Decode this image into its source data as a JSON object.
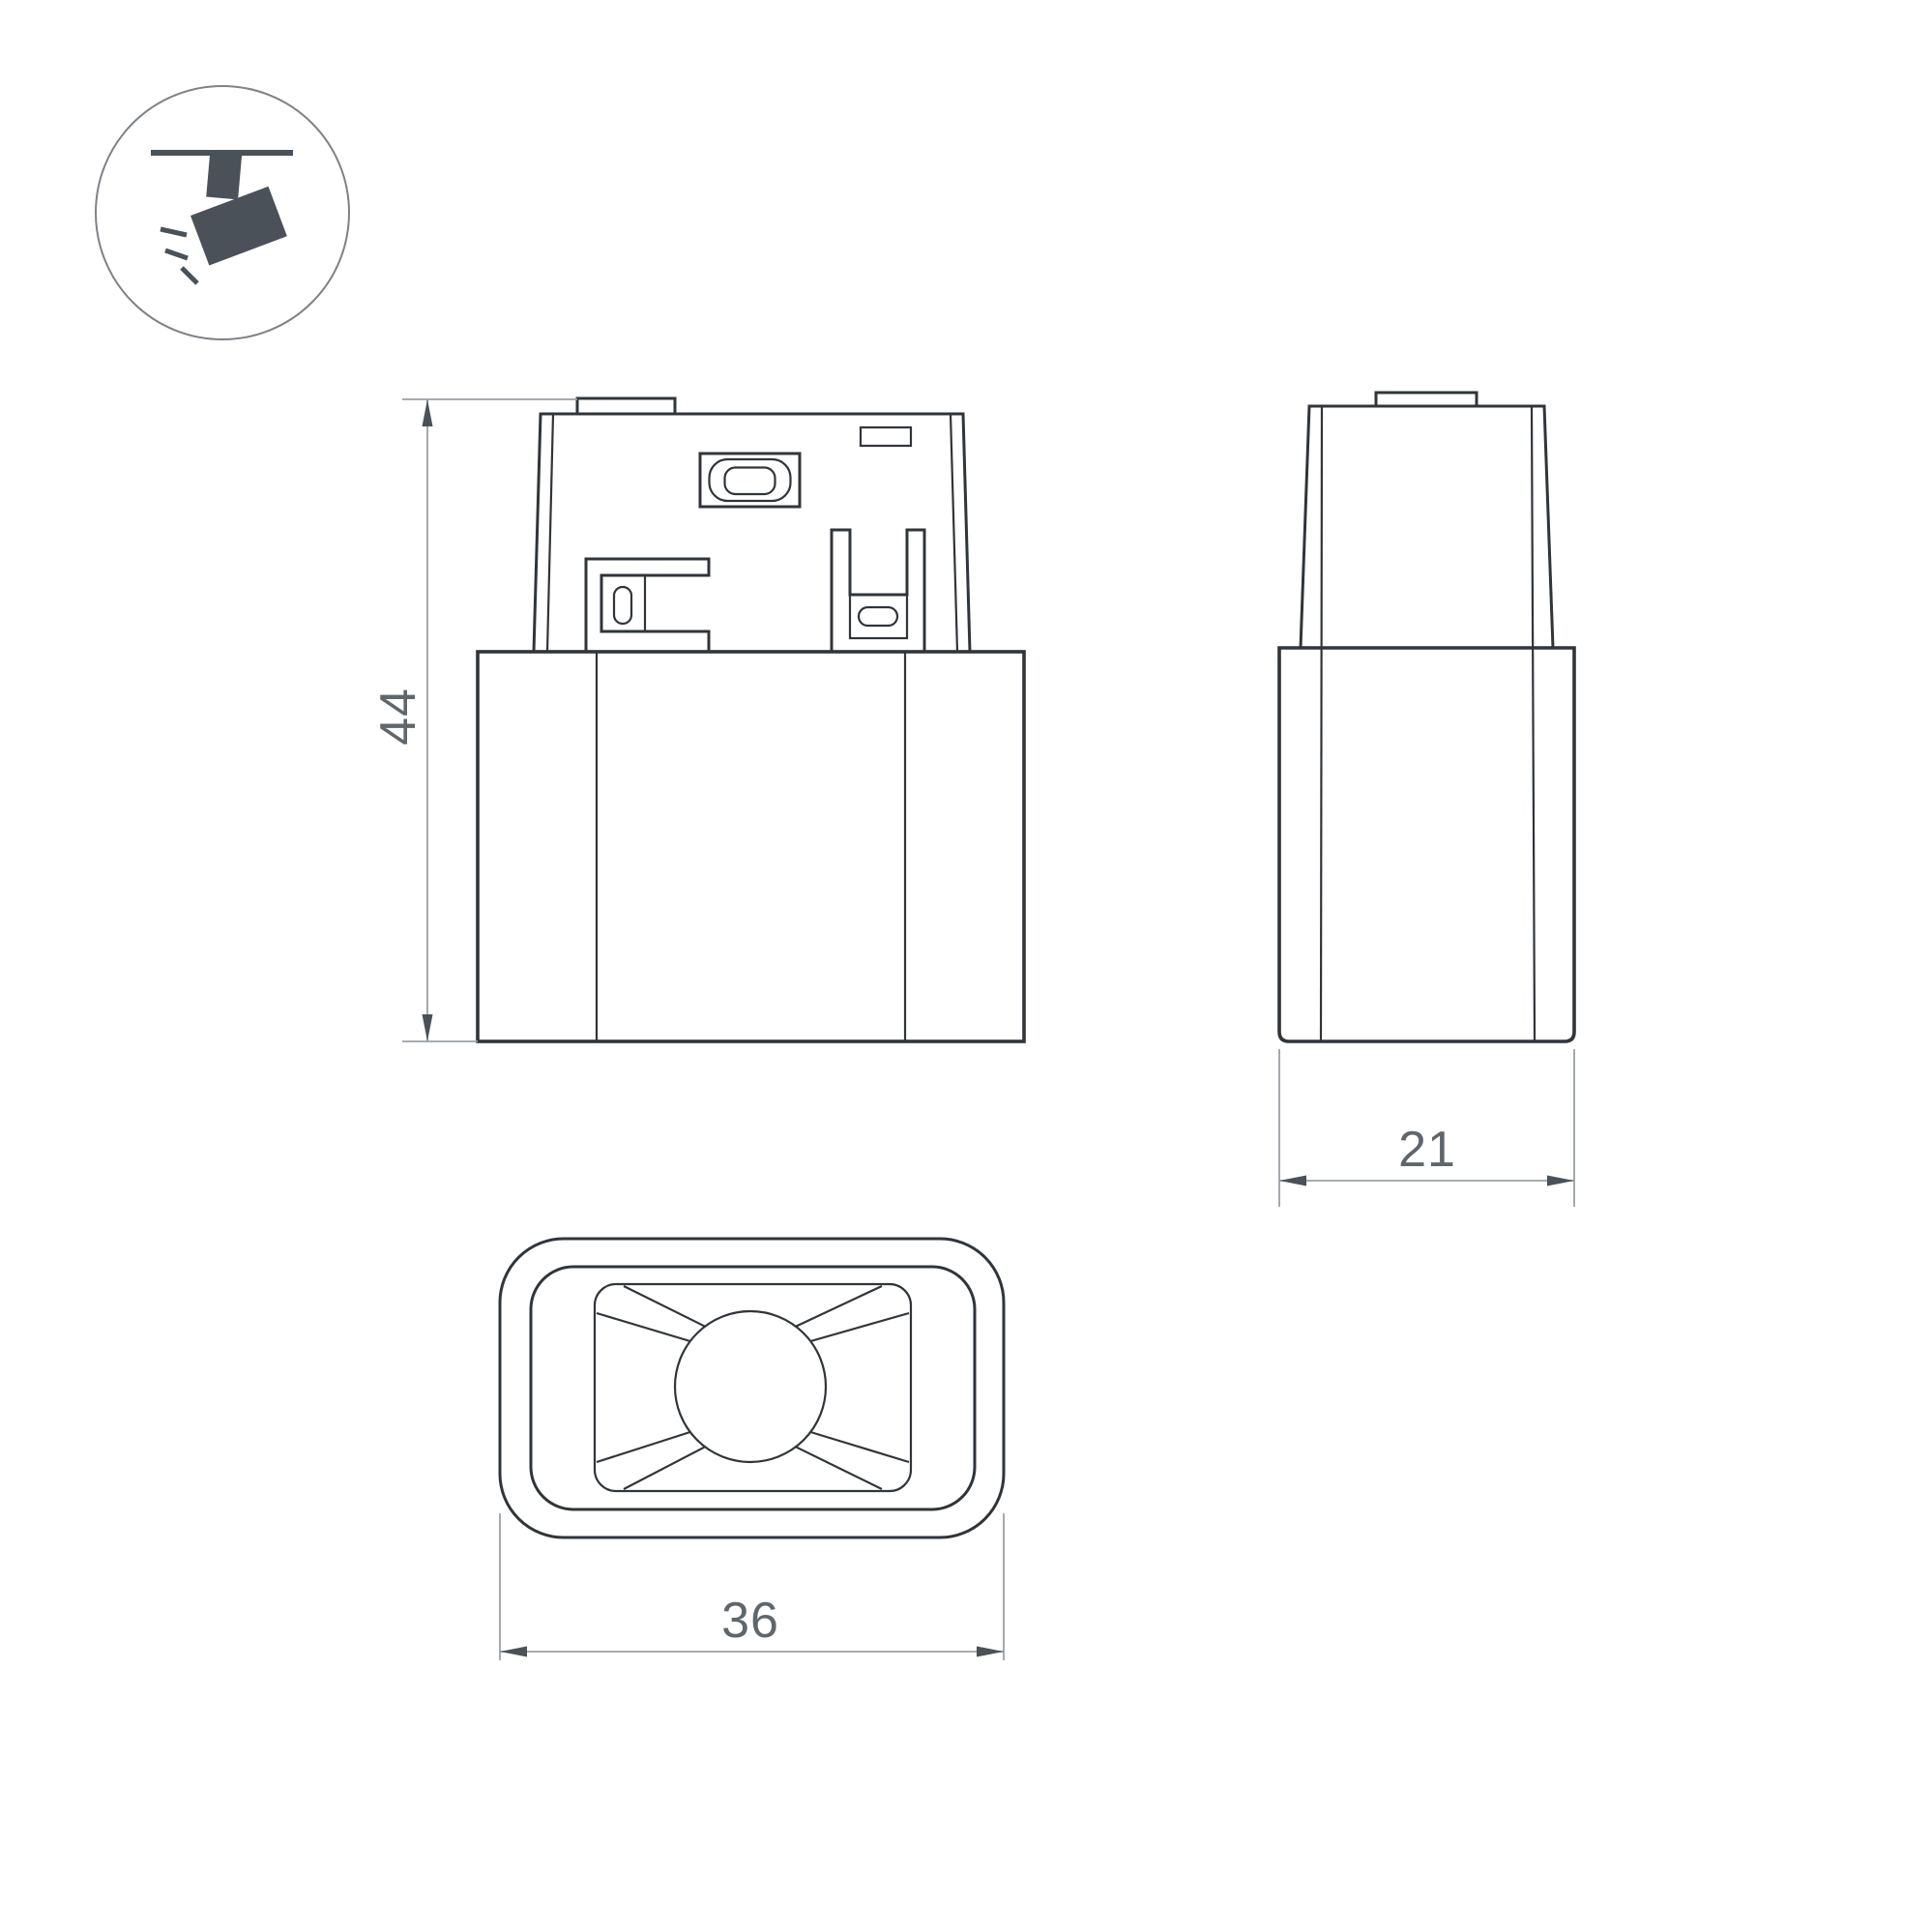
{
  "title": "luminaire-dimension-drawing",
  "colors": {
    "background": "#ffffff",
    "outline": "#30353a",
    "dimension_lines": "#9aa0a5",
    "arrows_and_icon": "#4a5158",
    "text": "#5f666c"
  },
  "icon": {
    "name": "track-spotlight-icon"
  },
  "dimensions": {
    "height": {
      "value": "44"
    },
    "depth": {
      "value": "21"
    },
    "width": {
      "value": "36"
    }
  }
}
